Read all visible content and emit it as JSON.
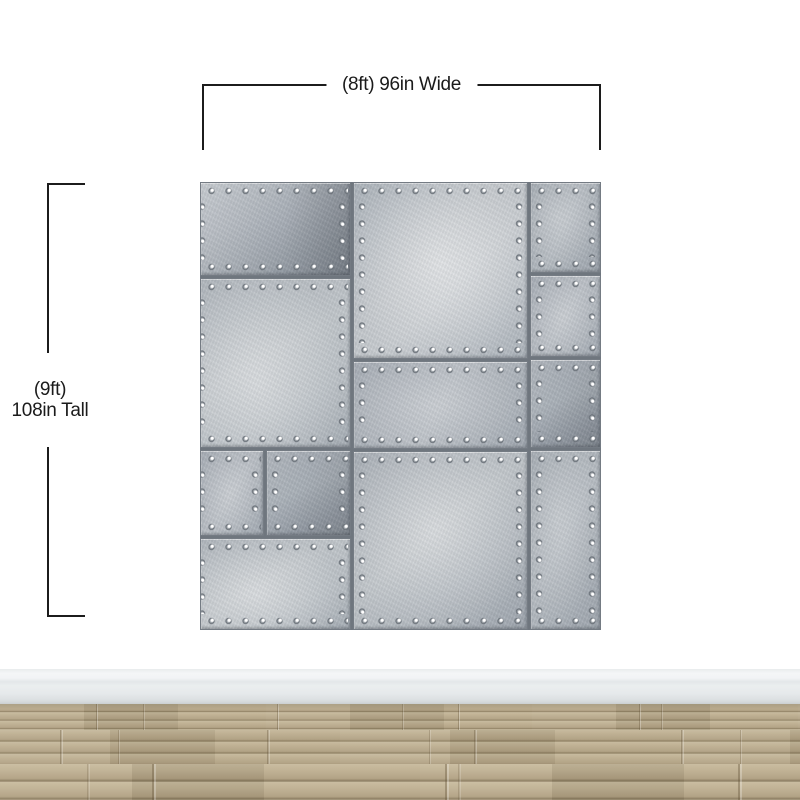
{
  "annotations": {
    "width_label": "(8ft) 96in Wide",
    "height_label_line1": "(9ft)",
    "height_label_line2": "108in Tall"
  },
  "colors": {
    "annotation_line": "#1c1c1c",
    "wall": "#ffffff",
    "metal_light": "#ced2d6",
    "metal_mid": "#aab0b7",
    "metal_dark": "#8f969e",
    "rivet_highlight": "#ffffff",
    "baseboard": "#e7eaec",
    "floor_wood": "#b9aa8c"
  }
}
